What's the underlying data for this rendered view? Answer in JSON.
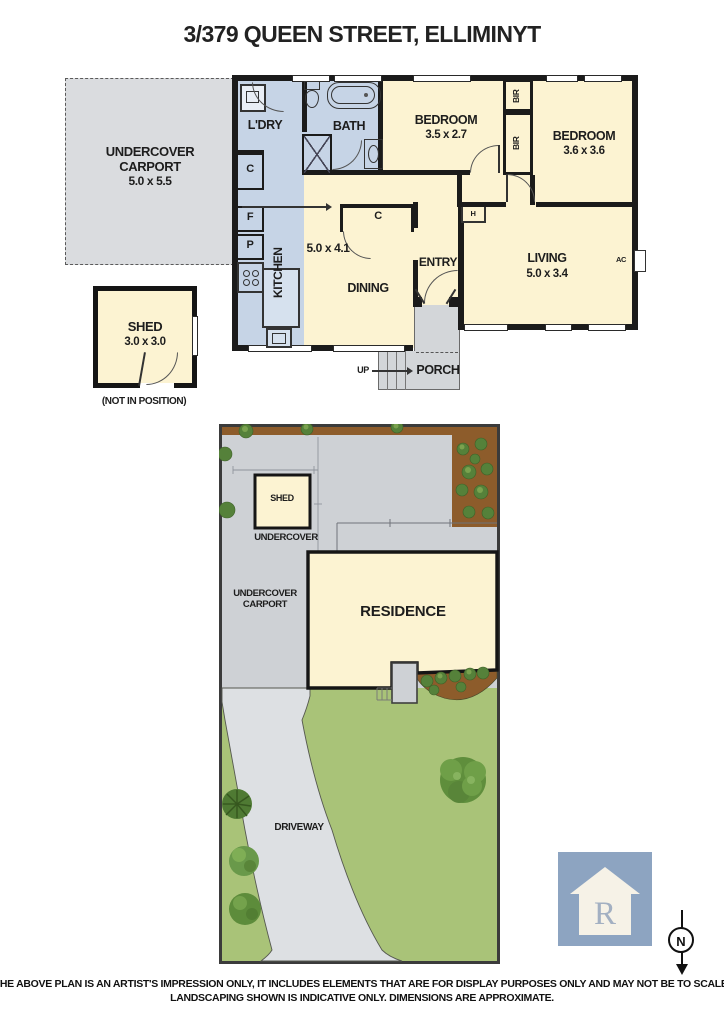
{
  "title": "3/379 QUEEN STREET, ELLIMINYT",
  "floorplan": {
    "carport": {
      "line1": "UNDERCOVER",
      "line2": "CARPORT",
      "dims": "5.0 x 5.5"
    },
    "laundry": {
      "label": "L'DRY"
    },
    "bath": {
      "label": "BATH"
    },
    "bedroom1": {
      "label": "BEDROOM",
      "dims": "3.5 x 2.7"
    },
    "bedroom2": {
      "label": "BEDROOM",
      "dims": "3.6 x 3.6"
    },
    "kitchen": {
      "label": "KITCHEN"
    },
    "hall": {
      "dims": "5.0 x 4.1"
    },
    "dining": {
      "label": "DINING"
    },
    "entry": {
      "label": "ENTRY"
    },
    "living": {
      "label": "LIVING",
      "dims": "5.0 x 3.4"
    },
    "shed": {
      "label": "SHED",
      "dims": "3.0 x 3.0",
      "note": "(NOT IN POSITION)"
    },
    "porch": {
      "label": "PORCH",
      "up": "UP"
    },
    "fixtures": {
      "cupboard": "C",
      "fridge": "F",
      "pantry": "P",
      "robe": "BIR",
      "heater": "H",
      "aircon": "AC"
    }
  },
  "siteplan": {
    "shed": "SHED",
    "undercover": "UNDERCOVER",
    "carport": {
      "line1": "UNDERCOVER",
      "line2": "CARPORT"
    },
    "residence": "RESIDENCE",
    "driveway": "DRIVEWAY"
  },
  "compass": {
    "label": "N"
  },
  "logo": {
    "letter": "R"
  },
  "disclaimer": {
    "line1": "THE ABOVE PLAN IS AN ARTIST'S IMPRESSION ONLY, IT INCLUDES ELEMENTS THAT ARE FOR DISPLAY PURPOSES ONLY AND MAY NOT BE TO SCALE.",
    "line2": "LANDSCAPING SHOWN IS INDICATIVE ONLY. DIMENSIONS ARE APPROXIMATE."
  },
  "colors": {
    "wall": "#1b1b1b",
    "room_cream": "#fcf3d2",
    "room_blue": "#c6d4e6",
    "concrete": "#ced1d5",
    "driveway": "#dde0e3",
    "grass": "#a9c378",
    "garden_brown": "#8d5c2b",
    "logo_blue": "#8da4c1"
  }
}
